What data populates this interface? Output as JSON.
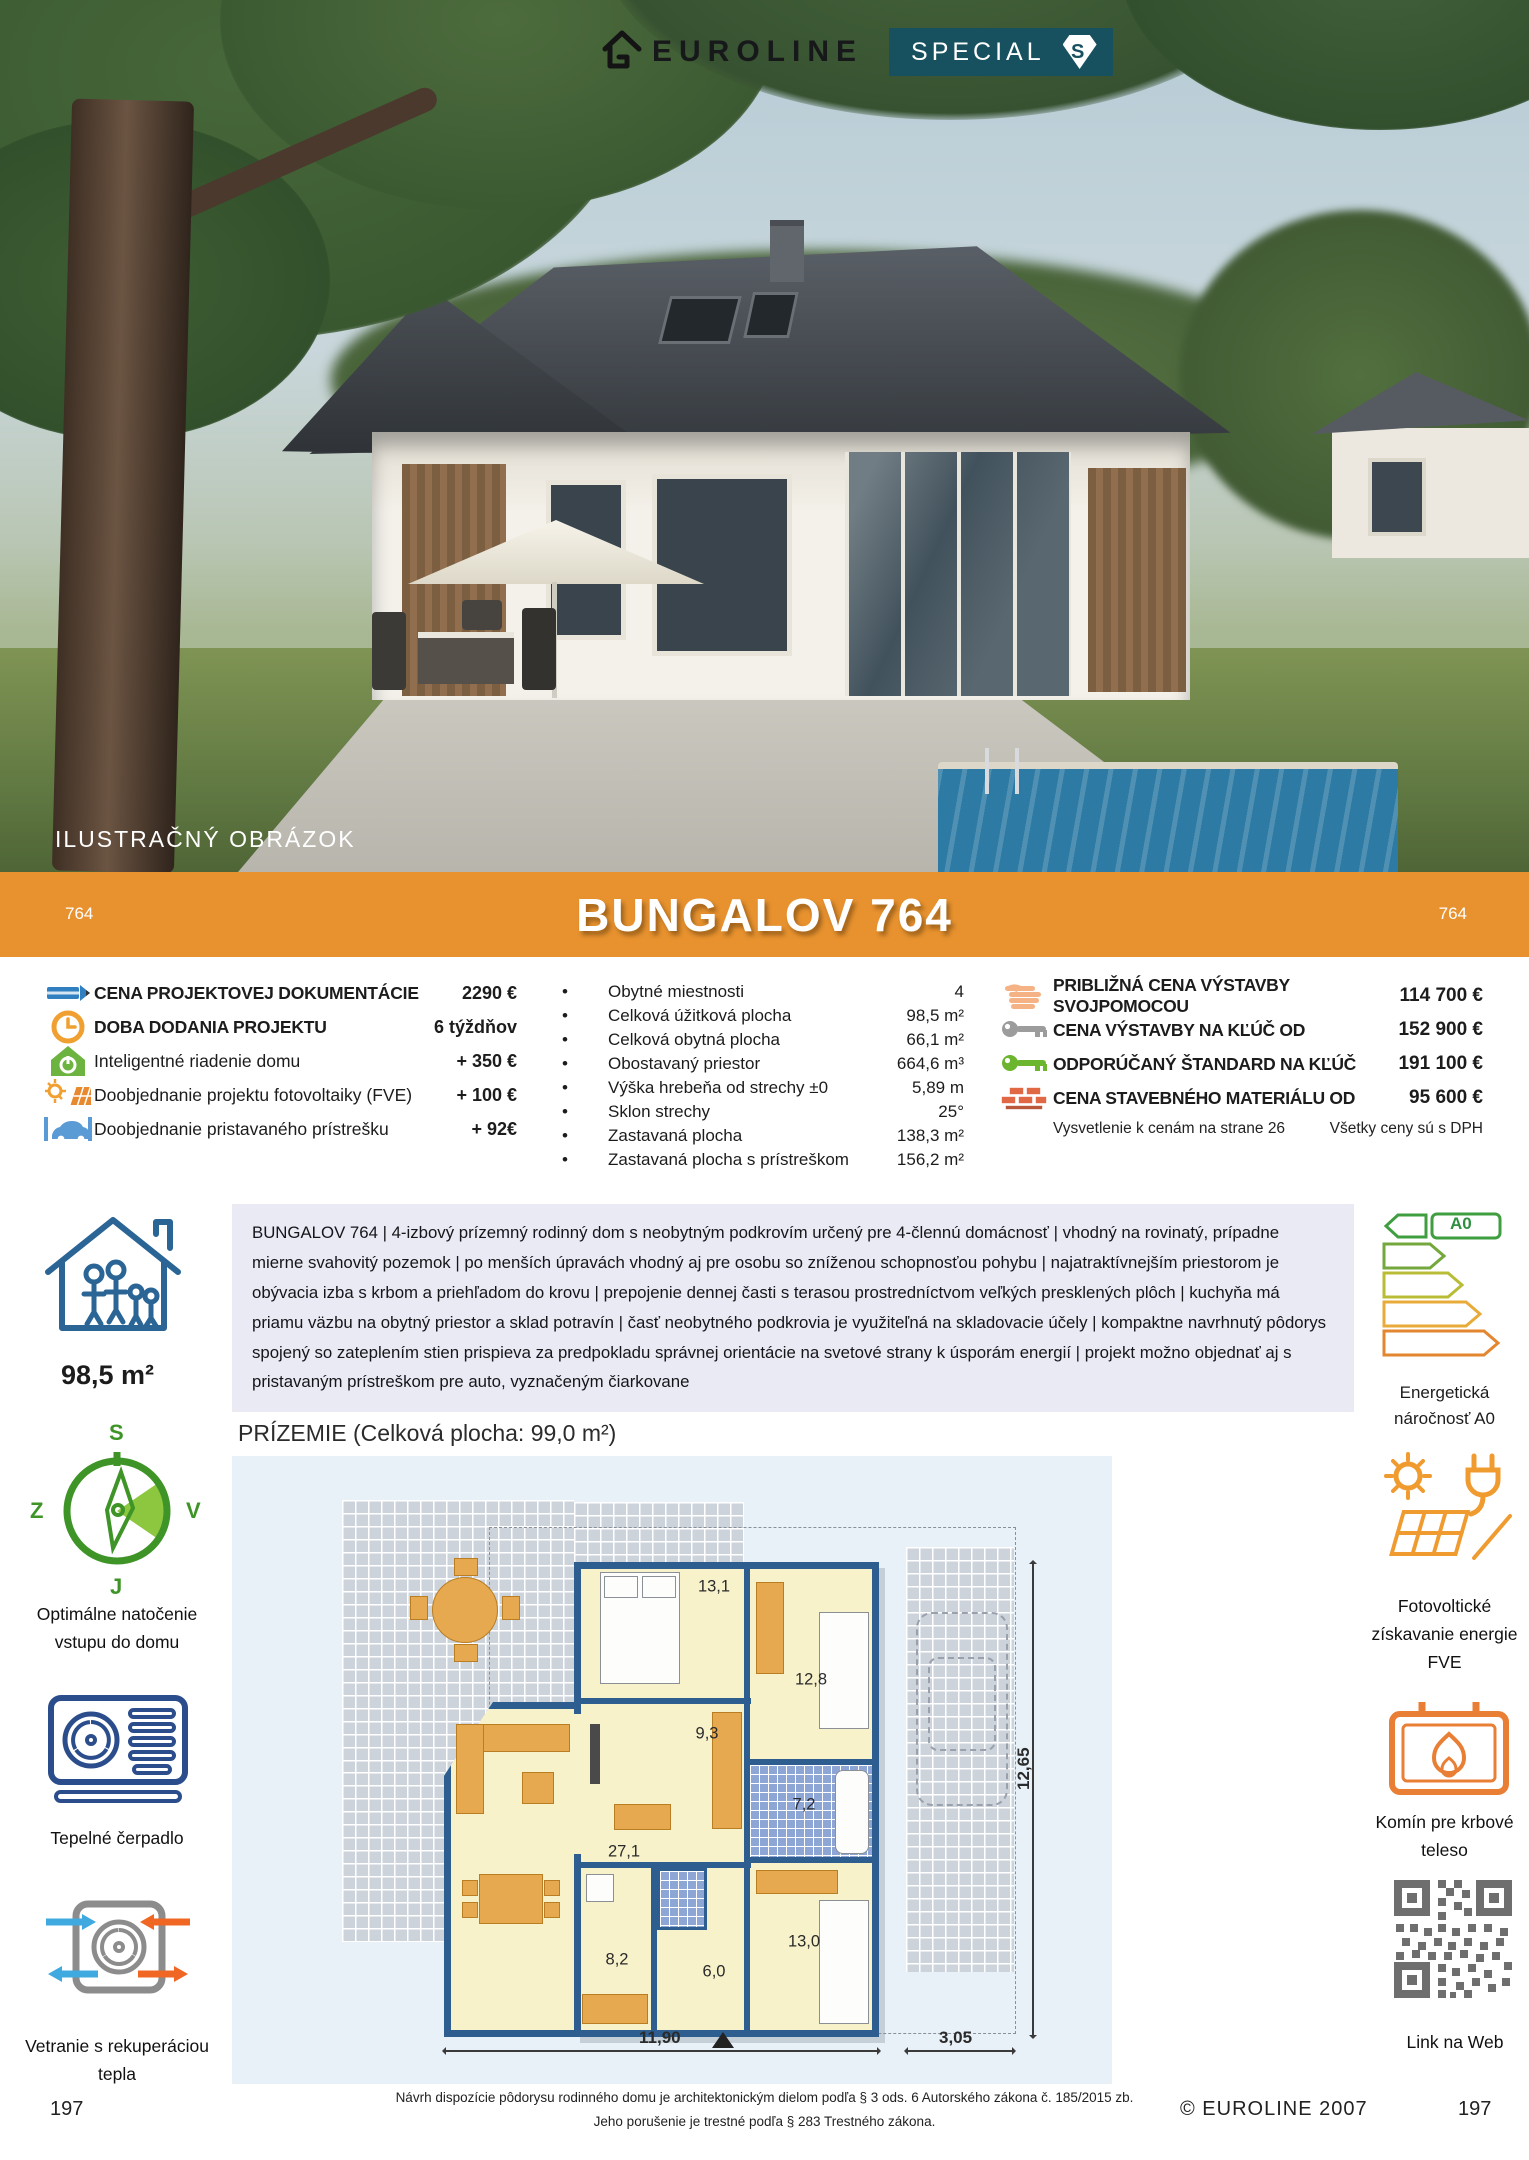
{
  "brand": {
    "logo_text": "EUROLINE",
    "badge": "SPECIAL",
    "badge_letter": "S",
    "badge_color": "#17505F",
    "accent_color": "#E8922F"
  },
  "photo": {
    "caption": "ILUSTRAČNÝ OBRÁZOK"
  },
  "banner": {
    "title": "BUNGALOV 764",
    "code_left": "764",
    "code_right": "764",
    "color": "#E8922F"
  },
  "specs_left": {
    "items": [
      {
        "icon": "pencil-icon",
        "label": "CENA PROJEKTOVEJ DOKUMENTÁCIE",
        "value": "2290 €"
      },
      {
        "icon": "clock-icon",
        "label": "DOBA DODANIA PROJEKTU",
        "value": "6 týždňov"
      },
      {
        "icon": "smart-home-icon",
        "label": "Inteligentné riadenie domu",
        "value": "+ 350 €"
      },
      {
        "icon": "solar-icon",
        "label": "Doobjednanie projektu fotovoltaiky (FVE)",
        "value": "+ 100 €"
      },
      {
        "icon": "carport-icon",
        "label": "Doobjednanie pristavaného prístrešku",
        "value": "+ 92€"
      }
    ]
  },
  "specs_middle": {
    "items": [
      {
        "label": "Obytné miestnosti",
        "value": "4"
      },
      {
        "label": "Celková úžitková plocha",
        "value": "98,5 m²"
      },
      {
        "label": "Celková obytná plocha",
        "value": "66,1 m²"
      },
      {
        "label": "Obostavaný priestor",
        "value": "664,6 m³"
      },
      {
        "label": "Výška hrebeňa od strechy ±0",
        "value": "5,89 m"
      },
      {
        "label": "Sklon strechy",
        "value": "25°"
      },
      {
        "label": "Zastavaná plocha",
        "value": "138,3 m²"
      },
      {
        "label": "Zastavaná plocha s prístreškom",
        "value": "156,2 m²"
      }
    ]
  },
  "specs_right": {
    "items": [
      {
        "icon": "hand-icon",
        "label": "PRIBLIŽNÁ CENA VÝSTAVBY SVOJPOMOCOU",
        "value": "114 700 €"
      },
      {
        "icon": "key-grey-icon",
        "label": "CENA VÝSTAVBY NA KĽÚČ OD",
        "value": "152 900 €"
      },
      {
        "icon": "key-green-icon",
        "label": "ODPORÚČANÝ ŠTANDARD NA KĽÚČ",
        "value": "191 100 €"
      },
      {
        "icon": "bricks-icon",
        "label": "CENA STAVEBNÉHO MATERIÁLU OD",
        "value": "95 600 €"
      }
    ],
    "note_left": "Vysvetlenie k cenám na strane 26",
    "note_right": "Všetky ceny sú s DPH"
  },
  "description": {
    "area_label": "98,5 m²",
    "text": "BUNGALOV 764 | 4-izbový prízemný rodinný dom s neobytným podkrovím určený pre 4-člennú domácnosť | vhodný na rovinatý, prípadne mierne svahovitý pozemok | po menších úpravách vhodný aj pre osobu so zníženou schopnosťou pohybu | najatraktívnejším priestorom je obývacia izba s krbom a priehľadom do krovu | prepojenie dennej časti s terasou prostredníctvom veľkých presklených plôch | kuchyňa má priamu väzbu na obytný priestor a sklad potravín | časť neobytného podkrovia je využiteľná na skladovacie účely | kompaktne navrhnutý pôdorys spojený so zateplením stien prispieva za predpokladu správnej orientácie na svetové strany k úsporám energií | projekt možno objednať aj s pristavaným prístreškom pre auto, vyznačeným čiarkovane",
    "energy_badge": "A0",
    "energy_label": "Energetická náročnosť A0"
  },
  "sidebar_left": {
    "compass": {
      "north": "S",
      "east": "V",
      "south": "J",
      "west": "Z"
    },
    "items": [
      {
        "icon": "compass-icon",
        "label": "Optimálne natočenie vstupu do domu"
      },
      {
        "icon": "heat-pump-icon",
        "label": "Tepelné čerpadlo"
      },
      {
        "icon": "ventilation-icon",
        "label": "Vetranie s rekuperáciou tepla"
      }
    ]
  },
  "sidebar_right": {
    "items": [
      {
        "icon": "fve-icon",
        "label": "Fotovoltické získavanie energie FVE"
      },
      {
        "icon": "chimney-icon",
        "label": "Komín pre krbové teleso"
      },
      {
        "icon": "qr-code",
        "label": "Link na Web"
      }
    ]
  },
  "plan": {
    "title": "PRÍZEMIE (Celková plocha: 99,0 m²)",
    "rooms": [
      {
        "area": "13,1"
      },
      {
        "area": "12,8"
      },
      {
        "area": "9,3"
      },
      {
        "area": "7,2"
      },
      {
        "area": "27,1"
      },
      {
        "area": "8,2"
      },
      {
        "area": "6,0"
      },
      {
        "area": "13,0"
      }
    ],
    "dimensions": {
      "width_main": "11,90",
      "width_carport": "3,05",
      "height": "12,65"
    }
  },
  "footer": {
    "page_left": "197",
    "page_right": "197",
    "copyright": "© EUROLINE 2007",
    "legal_line1": "Návrh dispozície pôdorysu rodinného domu je architektonickým dielom podľa § 3 ods. 6 Autorského zákona č. 185/2015 zb.",
    "legal_line2": "Jeho porušenie je trestné podľa § 283 Trestného zákona."
  }
}
